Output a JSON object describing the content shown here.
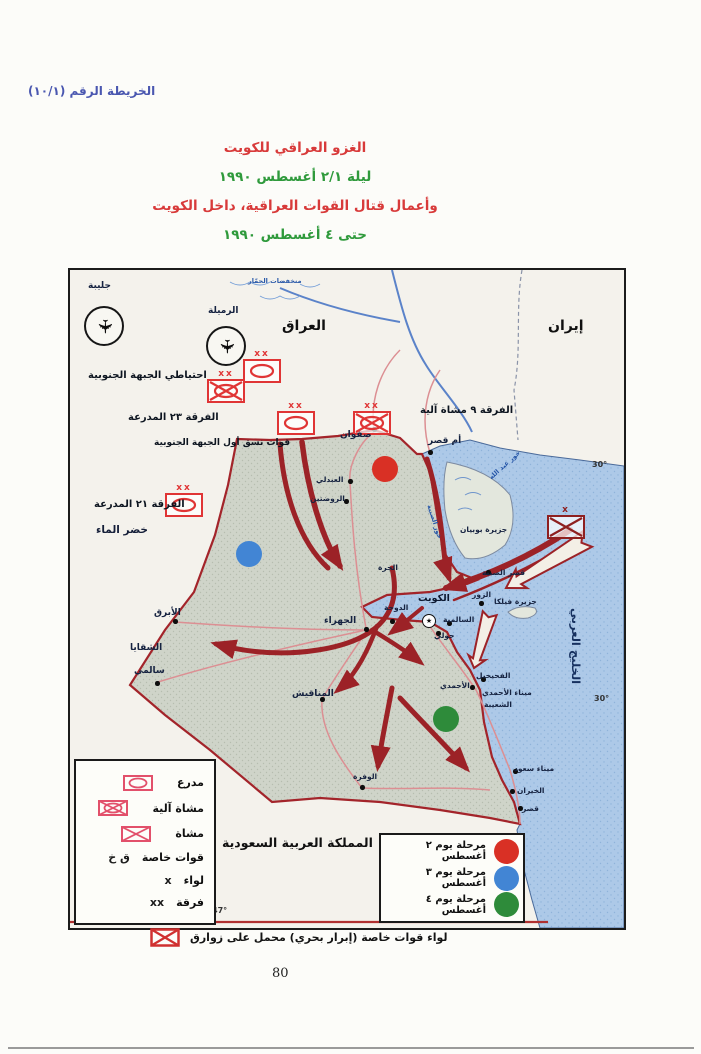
{
  "palette": {
    "header_blue": "#4a57b0",
    "title_red": "#d83a3a",
    "title_green": "#2f9a3c",
    "arrow_red": "#9c2227",
    "field_symbol_red": "#e03535",
    "sea_symbol_dark_red": "#8e2020",
    "legend_symbol_pink": "#e2506b",
    "sea_blue": "#adc9e8",
    "kuwait_fill": "#cfd4c9",
    "phase_red": "#d93025",
    "phase_blue": "#4285d4",
    "phase_green": "#2e8b3a"
  },
  "header": {
    "map_ref": "الخريطة الرقم (١٠/١)"
  },
  "title": {
    "lines": [
      {
        "t": "الغزو العراقي للكويت",
        "color": "#d83a3a"
      },
      {
        "t": "ليلة ٢/١ أغسطس ١٩٩٠",
        "color": "#2f9a3c"
      },
      {
        "t": "وأعمال قتال القوات العراقية، داخل الكويت",
        "color": "#d83a3a"
      },
      {
        "t": "حتى ٤ أغسطس ١٩٩٠",
        "color": "#2f9a3c"
      }
    ]
  },
  "map": {
    "labels": [
      {
        "t": "جليبة",
        "x": 18,
        "y": 11,
        "cls": "p9",
        "n": "airbase-label-jalibah"
      },
      {
        "t": "الرميلة",
        "x": 138,
        "y": 36,
        "cls": "p9",
        "n": "airbase-label-rumaila"
      },
      {
        "t": "منخفضات الحمّار",
        "x": 178,
        "y": 8,
        "cls": "blue7",
        "n": "hammar-depressions-label"
      },
      {
        "t": "العراق",
        "x": 212,
        "y": 48,
        "cls": "c14",
        "n": "country-label-iraq"
      },
      {
        "t": "إيران",
        "x": 478,
        "y": 48,
        "cls": "c14",
        "n": "country-label-iran"
      },
      {
        "t": "احتياطي الجبهة الجنوبية",
        "x": 18,
        "y": 100,
        "cls": "db",
        "n": "southern-front-reserve-label"
      },
      {
        "t": "الفرقة ٢٣ المدرعة",
        "x": 58,
        "y": 142,
        "cls": "db",
        "n": "division-23-armored-label"
      },
      {
        "t": "الفرقة ٩ مشاة آلية",
        "x": 350,
        "y": 135,
        "cls": "db",
        "n": "division-9-mech-label"
      },
      {
        "t": "قوات نسق أول الجبهة الجنوبية",
        "x": 84,
        "y": 168,
        "cls": "db2",
        "n": "first-echelon-label"
      },
      {
        "t": "الفرقة ٢١ المدرعة",
        "x": 24,
        "y": 229,
        "cls": "db",
        "n": "division-21-armored-label"
      },
      {
        "t": "خضر الماء",
        "x": 26,
        "y": 254,
        "cls": "kh"
      },
      {
        "t": "صفوان",
        "x": 270,
        "y": 160,
        "cls": "p9"
      },
      {
        "t": "أم قصر",
        "x": 358,
        "y": 166,
        "cls": "p9"
      },
      {
        "t": "العبدلي",
        "x": 246,
        "y": 206,
        "cls": "p8"
      },
      {
        "t": "الروضتين",
        "x": 240,
        "y": 225,
        "cls": "p8"
      },
      {
        "t": "الجرة",
        "x": 308,
        "y": 294,
        "cls": "p8"
      },
      {
        "t": "الجهراء",
        "x": 254,
        "y": 346,
        "cls": "p9"
      },
      {
        "t": "الدوحة",
        "x": 314,
        "y": 334,
        "cls": "p8"
      },
      {
        "t": "الكويت",
        "x": 348,
        "y": 324,
        "cls": "kb",
        "n": "city-label-kuwait"
      },
      {
        "t": "السالمية",
        "x": 373,
        "y": 346,
        "cls": "p8"
      },
      {
        "t": "حولي",
        "x": 364,
        "y": 362,
        "cls": "p8"
      },
      {
        "t": "جزيرة فيلكا",
        "x": 424,
        "y": 328,
        "cls": "p8"
      },
      {
        "t": "الزور",
        "x": 402,
        "y": 321,
        "cls": "p8"
      },
      {
        "t": "قصر الصبية",
        "x": 412,
        "y": 299,
        "cls": "p8"
      },
      {
        "t": "جزيرة بوبيان",
        "x": 390,
        "y": 256,
        "cls": "p8"
      },
      {
        "t": "خور عبد الله",
        "x": 418,
        "y": 206,
        "cls": "blue7",
        "rot": -42
      },
      {
        "t": "خور الصبية",
        "x": 362,
        "y": 234,
        "cls": "blue7",
        "rot": 72
      },
      {
        "t": "الفحيحيل",
        "x": 406,
        "y": 402,
        "cls": "p8"
      },
      {
        "t": "الأحمدي",
        "x": 370,
        "y": 412,
        "cls": "p8"
      },
      {
        "t": "ميناء الأحمدي",
        "x": 412,
        "y": 419,
        "cls": "p8"
      },
      {
        "t": "الشعيبة",
        "x": 414,
        "y": 431,
        "cls": "p8"
      },
      {
        "t": "ميناء سعود",
        "x": 444,
        "y": 495,
        "cls": "p8"
      },
      {
        "t": "الخيران",
        "x": 447,
        "y": 517,
        "cls": "p8"
      },
      {
        "t": "قصر",
        "x": 452,
        "y": 535,
        "cls": "p8"
      },
      {
        "t": "الوفرة",
        "x": 283,
        "y": 503,
        "cls": "p8"
      },
      {
        "t": "المناقيش",
        "x": 222,
        "y": 419,
        "cls": "p9"
      },
      {
        "t": "الأبرق",
        "x": 84,
        "y": 338,
        "cls": "p9"
      },
      {
        "t": "الشقايا",
        "x": 60,
        "y": 373,
        "cls": "p9"
      },
      {
        "t": "سالمي",
        "x": 64,
        "y": 396,
        "cls": "p9"
      },
      {
        "t": "الخليج العربي",
        "x": 512,
        "y": 338,
        "cls": "gulf",
        "rot": 90,
        "n": "gulf-label"
      },
      {
        "t": "المملكة العربية السعودية",
        "x": 152,
        "y": 566,
        "cls": "c12",
        "n": "country-label-saudi-arabia"
      },
      {
        "t": "30°",
        "x": 522,
        "y": 190,
        "cls": "deg"
      },
      {
        "t": "30°",
        "x": 524,
        "y": 424,
        "cls": "deg"
      },
      {
        "t": "47°",
        "x": 142,
        "y": 636,
        "cls": "deg"
      }
    ],
    "dots": [
      {
        "x": 302,
        "y": 157
      },
      {
        "x": 358,
        "y": 180
      },
      {
        "x": 278,
        "y": 209
      },
      {
        "x": 274,
        "y": 229
      },
      {
        "x": 294,
        "y": 357
      },
      {
        "x": 320,
        "y": 349
      },
      {
        "x": 377,
        "y": 351
      },
      {
        "x": 366,
        "y": 361
      },
      {
        "x": 411,
        "y": 407
      },
      {
        "x": 400,
        "y": 415
      },
      {
        "x": 290,
        "y": 515
      },
      {
        "x": 250,
        "y": 427
      },
      {
        "x": 103,
        "y": 349
      },
      {
        "x": 85,
        "y": 411
      },
      {
        "x": 443,
        "y": 499
      },
      {
        "x": 440,
        "y": 519
      },
      {
        "x": 448,
        "y": 536
      },
      {
        "x": 409,
        "y": 331
      },
      {
        "x": 416,
        "y": 300
      }
    ],
    "units": [
      {
        "type": "armor",
        "x": 172,
        "y": 80,
        "ech": "xx"
      },
      {
        "type": "mech",
        "x": 136,
        "y": 100,
        "ech": "xx"
      },
      {
        "type": "armor",
        "x": 206,
        "y": 132,
        "ech": "xx"
      },
      {
        "type": "mech",
        "x": 282,
        "y": 132,
        "ech": "xx"
      },
      {
        "type": "armor",
        "x": 94,
        "y": 214,
        "ech": "xx"
      },
      {
        "type": "inf",
        "x": 476,
        "y": 236,
        "ech": "x",
        "cls": "dark"
      }
    ],
    "aircraft": [
      {
        "x": 14,
        "y": 36
      },
      {
        "x": 136,
        "y": 56
      }
    ],
    "phases": [
      {
        "x": 302,
        "y": 186,
        "color": "#d93025"
      },
      {
        "x": 166,
        "y": 271,
        "color": "#4285d4"
      },
      {
        "x": 363,
        "y": 436,
        "color": "#2e8b3a"
      }
    ],
    "city_star": "★",
    "jet_glyph": "✈",
    "legend_units": {
      "rows": [
        {
          "type": "armor",
          "symtext": "",
          "label": "مدرع"
        },
        {
          "type": "mech",
          "symtext": "",
          "label": "مشاة آلية"
        },
        {
          "type": "inf",
          "symtext": "",
          "label": "مشاة"
        },
        {
          "symtext": "ق خ",
          "label": "قوات خاصة"
        },
        {
          "symtext": "x",
          "label": "لواء"
        },
        {
          "symtext": "xx",
          "label": "فرقة"
        }
      ]
    },
    "legend_phases": {
      "rows": [
        {
          "color": "#d93025",
          "label": "مرحلة يوم ٢ أغسطس"
        },
        {
          "color": "#4285d4",
          "label": "مرحلة يوم ٣ أغسطس"
        },
        {
          "color": "#2e8b3a",
          "label": "مرحلة يوم ٤ أغسطس"
        }
      ]
    }
  },
  "footer": {
    "caption": "لواء قوات خاصة (إبرار بحري) محمل على زوارق",
    "page_number": "80"
  }
}
